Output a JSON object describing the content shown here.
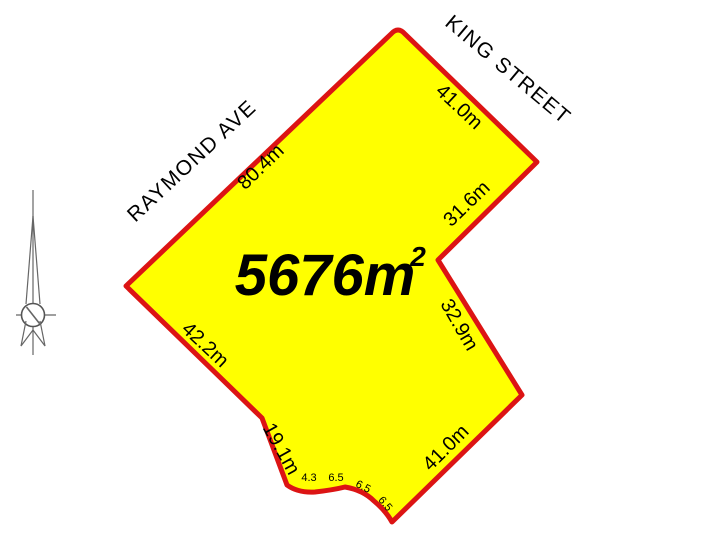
{
  "parcel": {
    "area_value": "5676m",
    "area_exponent": "2",
    "fill_color": "#FFFF00",
    "border_color": "#DC1414"
  },
  "streets": {
    "raymond": "RAYMOND AVE",
    "king": "KING STREET"
  },
  "dimensions": {
    "raymond_frontage": "80.4m",
    "king_frontage_upper": "41.0m",
    "notch_upper": "31.6m",
    "notch_lower": "32.9m",
    "southeast_boundary": "41.0m",
    "southwest_boundary": "42.2m",
    "south_short_boundary": "19.1m",
    "culdesac_segments": [
      "4.3",
      "6.5",
      "6.5",
      "6.5"
    ]
  },
  "compass": {
    "meaning": "north-arrow"
  },
  "colors": {
    "background": "#FFFFFF",
    "label_text": "#000000",
    "compass_line": "#666666"
  }
}
